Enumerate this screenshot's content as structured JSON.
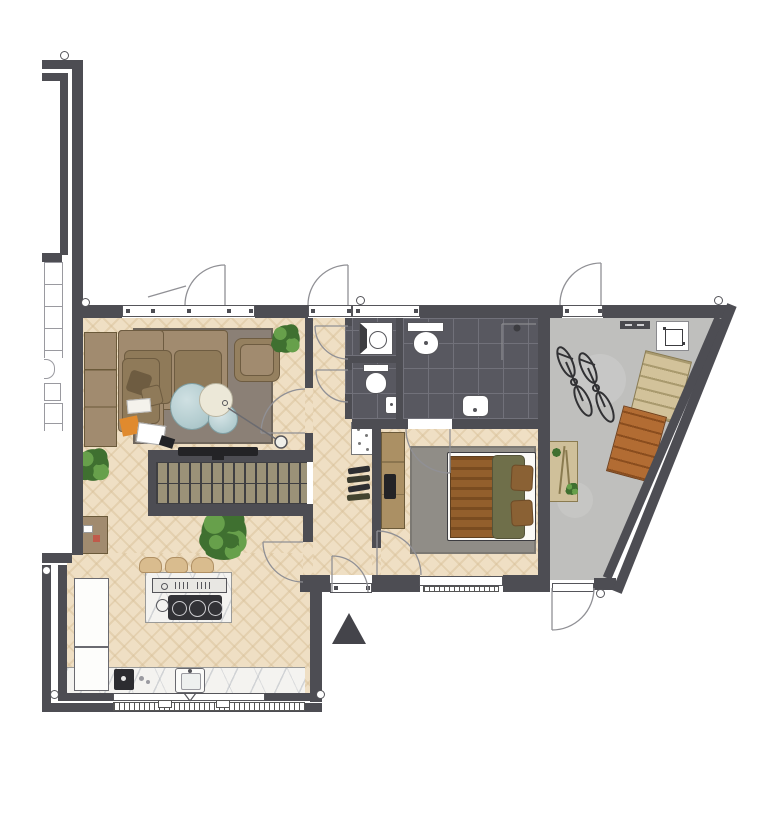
{
  "meta": {
    "title": "apartment-floor-plan",
    "type": "architectural-floor-plan-top-view",
    "visible_text": "none",
    "entrance_marker": "solid-dark-triangle-pointing-up",
    "door_swings": 11,
    "windows": 4,
    "wall_junction_markers": 8
  },
  "colors": {
    "wall": "#4d4d53",
    "thinline": "#9a9aa0",
    "wood": "#efdfc4",
    "tile": "#585860",
    "grout": "#71717a",
    "concrete": "#bfbfbd",
    "concreteLight": "#cdcdcb",
    "rugLiving": "#8b8076",
    "rugLivingEdge": "#6f665c",
    "rugBedroom": "#908d87",
    "rugBedroomEdge": "#7c7973",
    "sofa": "#a18b6f",
    "sofaCushion": "#8f7a59",
    "sofaDark": "#6e5c41",
    "armchair": "#95805f",
    "stairs": "#9b9278",
    "stairTread": "#3f3f42",
    "marble": "#f4f3f0",
    "stool": "#d9bc8e",
    "stoolEdge": "#b09064",
    "tvBlack": "#232326",
    "bedFrame": "#fbfaf7",
    "blanket": "#935f2c",
    "blanketStripe": "#7a4c20",
    "duvet": "#6f6f4a",
    "pillow": "#8a6134",
    "dresser": "#ab9064",
    "dresserEdge": "#6b5a3a",
    "crateTan": "#d2c29a",
    "crateTanLine": "#a99a6e",
    "crateBrick": "#b26c33",
    "crateBrickLine": "#8a4d1e",
    "bike": "#313134",
    "plant": "#67a04b",
    "plantDark": "#3f7030",
    "glass": "#b4cdd0",
    "glassEdge": "#7f9ea2",
    "cream": "#ece8d8",
    "arrow": "#44444a",
    "arcLine": "#909095",
    "fixture": "#55555a",
    "radiator": "#555555",
    "bench": "#cfc09a",
    "benchEdge": "#8a7b50",
    "orangeBook": "#e08a2e"
  },
  "rooms": [
    {
      "id": "living-room",
      "floor": "herringbone-wood",
      "furniture": [
        "corner-sofa",
        "armchair",
        "area-rug",
        "round-glass-coffee-table",
        "round-cream-side-table",
        "floor-lamp",
        "sideboard",
        "low-cabinet",
        "books-and-magazines",
        "wall-mounted-tv",
        "potted-plant-corner",
        "potted-plant-floor"
      ]
    },
    {
      "id": "kitchen",
      "floor": "herringbone-wood",
      "furniture": [
        "marble-island-with-gas-hob",
        "bar-stools-x3",
        "marble-counter-with-sink",
        "coffee-machine",
        "tall-white-cabinets-x2",
        "potted-plant",
        "window-with-radiator"
      ]
    },
    {
      "id": "hallway",
      "floor": "herringbone-wood",
      "furniture": [
        "staircase",
        "shoe-cabinet",
        "shoe-row",
        "large-potted-plant",
        "entry-door"
      ]
    },
    {
      "id": "bathroom",
      "floor": "dark-tile",
      "furniture": [
        "walk-in-shower",
        "washbasin",
        "toilet-with-shelf"
      ]
    },
    {
      "id": "wc",
      "floor": "dark-tile",
      "furniture": [
        "toilet",
        "small-washbasin"
      ]
    },
    {
      "id": "laundry",
      "floor": "dark-tile",
      "furniture": [
        "washing-machine"
      ]
    },
    {
      "id": "bedroom",
      "floor": "herringbone-wood",
      "furniture": [
        "double-bed-striped-blanket-olive-duvet",
        "gray-area-rug",
        "dresser-with-tv",
        "window-with-radiator"
      ]
    },
    {
      "id": "terrace-storage",
      "floor": "concrete",
      "furniture": [
        "bicycle-1",
        "bicycle-2",
        "crate-stack-tan",
        "crate-stack-brick",
        "garden-bench-with-tools",
        "heater-unit",
        "wall-shelf"
      ]
    },
    {
      "id": "communal-stairwell",
      "floor": "none",
      "furniture": [
        "exterior-stairs",
        "small-basin",
        "landing-box"
      ]
    }
  ]
}
